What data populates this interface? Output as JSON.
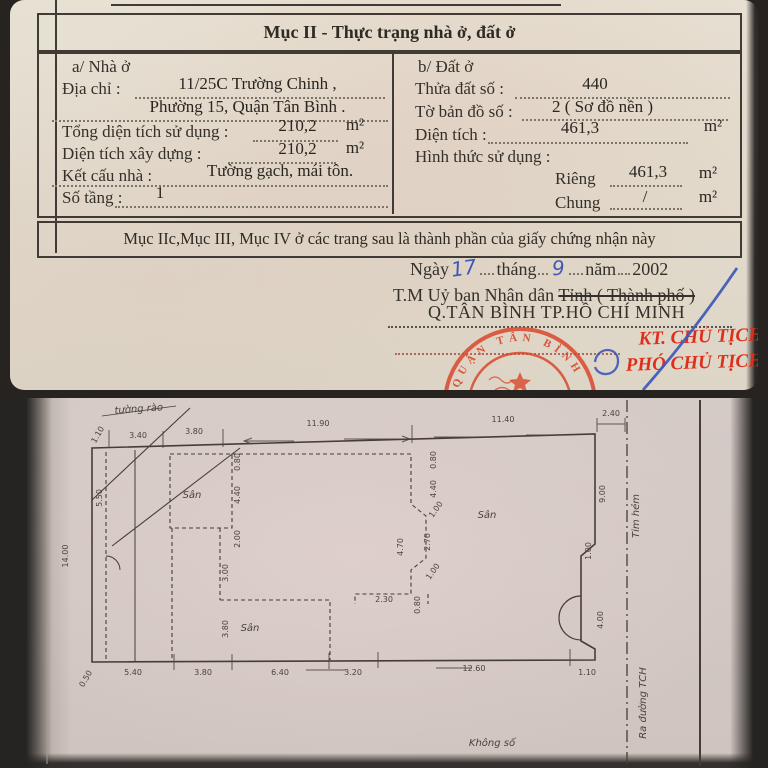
{
  "photo_top": {
    "title": "Mục II - Thực trạng nhà ở, đất ở",
    "house": {
      "heading": "a/ Nhà ở",
      "address_label": "Địa chỉ :",
      "address_value_line1": "11/25C Trường Chinh ,",
      "address_value_line2": "Phường 15, Quận Tân Bình .",
      "total_use_area_label": "Tổng diện tích sử dụng :",
      "total_use_area_value": "210,2",
      "built_area_label": "Diện tích xây dựng :",
      "built_area_value": "210,2",
      "structure_label": "Kết cấu nhà :",
      "structure_value": "Tường gạch, mái tôn.",
      "floors_label": "Số tầng :",
      "floors_value": "1",
      "area_unit": "m²"
    },
    "land": {
      "heading": "b/ Đất ở",
      "parcel_number_label": "Thửa đất số :",
      "parcel_number_value": "440",
      "map_sheet_label": "Tờ bản đồ số :",
      "map_sheet_value": "2 ( Sơ đồ nền )",
      "area_label": "Diện tích :",
      "area_value": "461,3",
      "use_form_label": "Hình thức sử dụng :",
      "private_label": "Riêng",
      "private_value": "461,3",
      "shared_label": "Chung",
      "shared_value": "/",
      "area_unit": "m²"
    },
    "footer_note": "Mục IIc,Mục III, Mục IV ở các trang sau là thành phần của giấy chứng nhận này",
    "issue": {
      "day_label": "Ngày",
      "day": "17",
      "month_label": "tháng",
      "month": "9",
      "year_label": "năm",
      "year": "2002",
      "authority": "T.M Uỷ ban Nhân dân",
      "authority_struck": "Tỉnh ( Thành phố )",
      "locality": "Q.TÂN BÌNH  TP.HỒ CHÍ MINH",
      "sign_title_1": "KT. CHỦ TỊCH",
      "sign_title_2": "PHÓ CHỦ TỊCH",
      "stamp_arc_text": "QUẬN TÂN BÌNH"
    }
  },
  "photo_plan": {
    "labels": {
      "fence": "tường rào",
      "yards": [
        "Sân",
        "Sân",
        "Sân"
      ],
      "no_number": "Không số",
      "alley_axis": "Tim hẻm",
      "road_out": "Ra đường TCH"
    },
    "dims": {
      "top": [
        "1.10",
        "3.40",
        "3.80",
        "11.90",
        "11.40",
        "2.40"
      ],
      "bottom": [
        "0.50",
        "5.40",
        "3.80",
        "6.40",
        "3.20",
        "12.60",
        "1.10"
      ],
      "left": [
        "14.00",
        "5.50"
      ],
      "right": [
        "9.00",
        "1.00",
        "4.00"
      ],
      "inner": [
        "0.80",
        "4.40",
        "2.00",
        "3.00",
        "3.80",
        "0.80",
        "4.40",
        "1.00",
        "4.70",
        "2.70",
        "1.00",
        "2.30",
        "0.80"
      ]
    }
  },
  "colors": {
    "stamp_red": "#d8472b",
    "sign_red": "#de2f1d",
    "ink_blue": "#3f58b8",
    "paper_top": "#e3dccf",
    "paper_plan": "#d5cbc6",
    "doc_ink": "#33302b",
    "plan_ink": "#453e37"
  }
}
